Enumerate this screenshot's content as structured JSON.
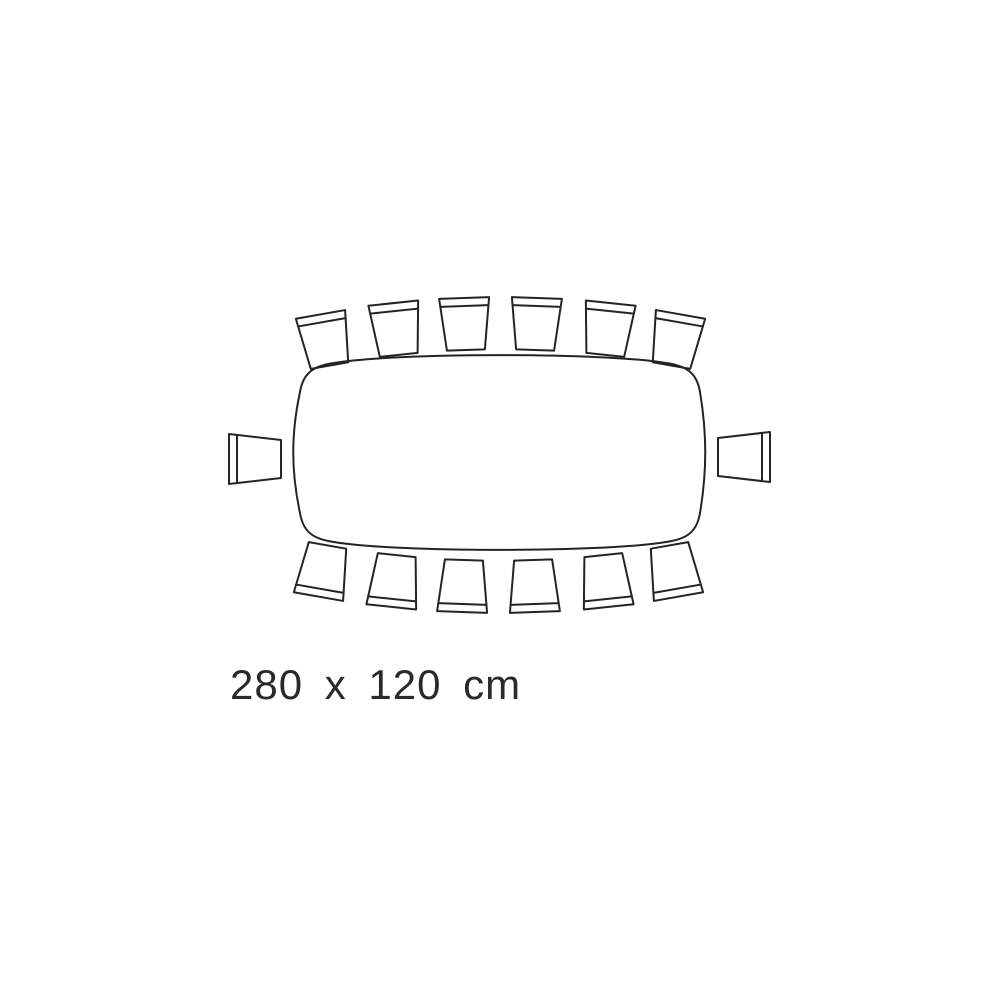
{
  "diagram": {
    "type": "table-seating-plan-top-view",
    "dimension_label": "280 x 120 cm",
    "table": {
      "shape": "rounded-rectangle-barrel",
      "width_cm": 280,
      "depth_cm": 120
    },
    "seats": {
      "total": 14,
      "top": 6,
      "bottom": 6,
      "left": 1,
      "right": 1
    },
    "colors": {
      "line": "#242424",
      "background": "#ffffff",
      "label_text": "#2a2a2a"
    }
  }
}
